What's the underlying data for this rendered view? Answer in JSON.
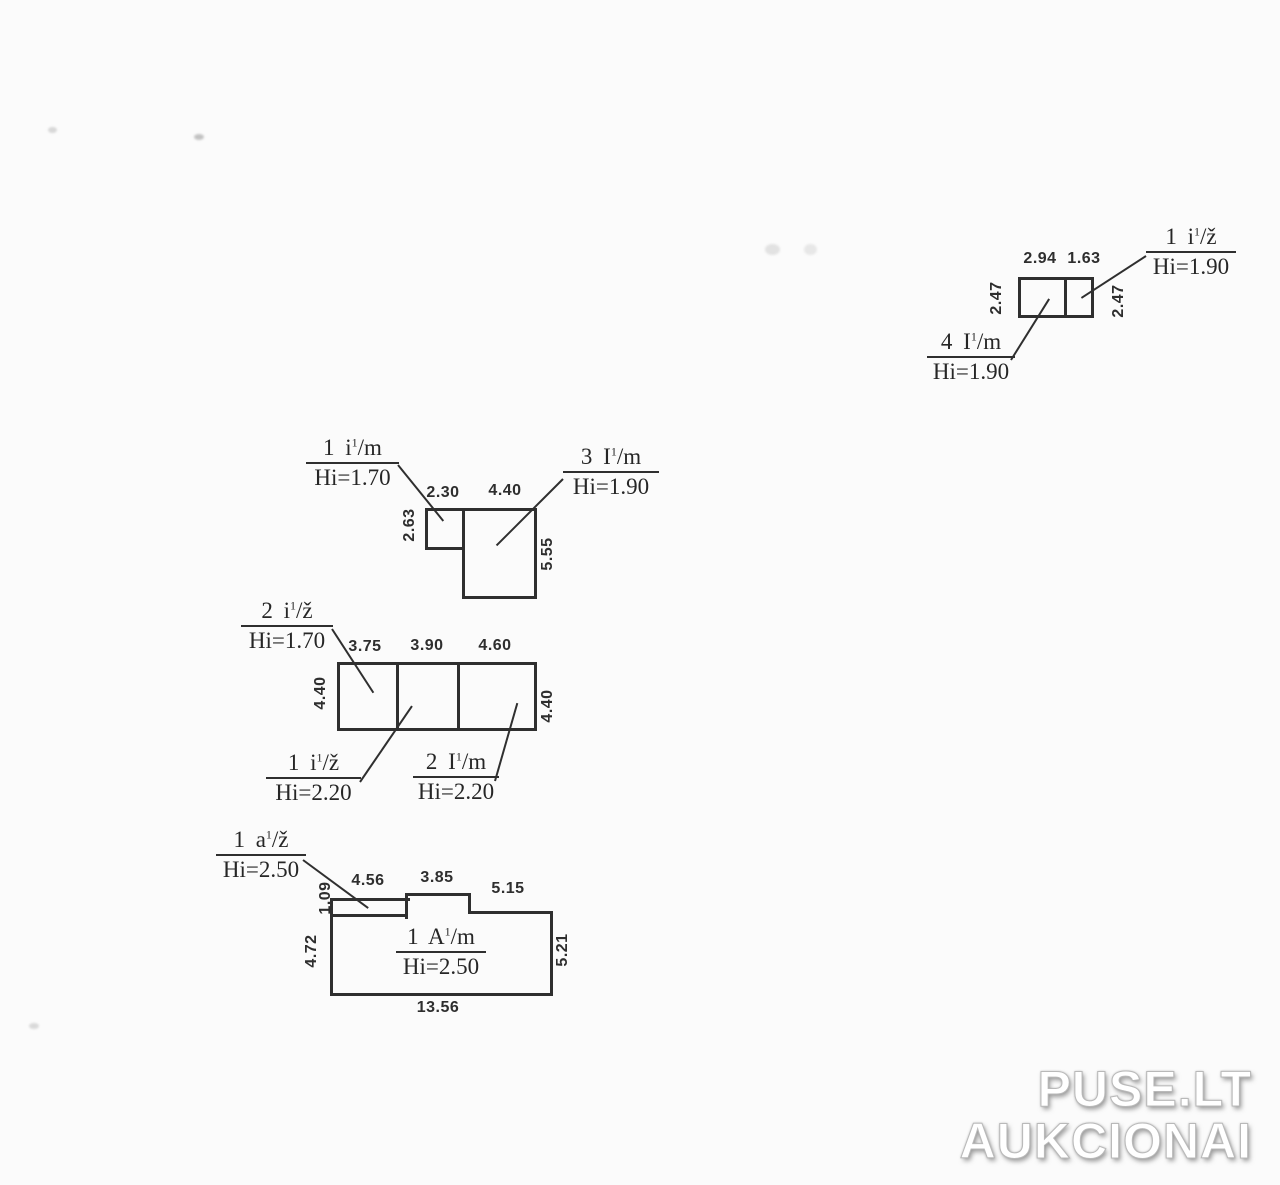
{
  "page": {
    "background": "#fbfbfb",
    "ink": "#2f2f2f"
  },
  "watermark": {
    "line1": "PUSE.LT",
    "line2": "AUKCIONAI"
  },
  "plan": {
    "b_top_right": {
      "dims": {
        "top_left": "2.94",
        "top_right": "1.63",
        "side_left": "2.47",
        "side_right": "2.47"
      },
      "label_ne": {
        "pre": "1 i",
        "sup": "1",
        "post": "/ž",
        "hi": "Hi=1.90"
      },
      "label_sw": {
        "pre": "4 I",
        "sup": "1",
        "post": "/m",
        "hi": "Hi=1.90"
      }
    },
    "b_mid": {
      "dims": {
        "top_small": "2.30",
        "top_big": "4.40",
        "side_small": "2.63",
        "side_big": "5.55"
      },
      "label_nw": {
        "pre": "1 i",
        "sup": "1",
        "post": "/m",
        "hi": "Hi=1.70"
      },
      "label_ne": {
        "pre": "3 I",
        "sup": "1",
        "post": "/m",
        "hi": "Hi=1.90"
      }
    },
    "b_three": {
      "dims": {
        "top_1": "3.75",
        "top_2": "3.90",
        "top_3": "4.60",
        "side_left": "4.40",
        "side_right": "4.40"
      },
      "label_nw": {
        "pre": "2 i",
        "sup": "1",
        "post": "/ž",
        "hi": "Hi=1.70"
      },
      "label_sw": {
        "pre": "1 i",
        "sup": "1",
        "post": "/ž",
        "hi": "Hi=2.20"
      },
      "label_se": {
        "pre": "2 I",
        "sup": "1",
        "post": "/m",
        "hi": "Hi=2.20"
      }
    },
    "b_main": {
      "dims": {
        "top_1": "4.56",
        "top_2": "3.85",
        "top_3": "5.15",
        "side_strip": "1.09",
        "side_left": "4.72",
        "side_right": "5.21",
        "bottom": "13.56"
      },
      "label_nw": {
        "pre": "1 a",
        "sup": "1",
        "post": "/ž",
        "hi": "Hi=2.50"
      },
      "label_center": {
        "pre": "1 A",
        "sup": "1",
        "post": "/m",
        "hi": "Hi=2.50"
      }
    }
  }
}
